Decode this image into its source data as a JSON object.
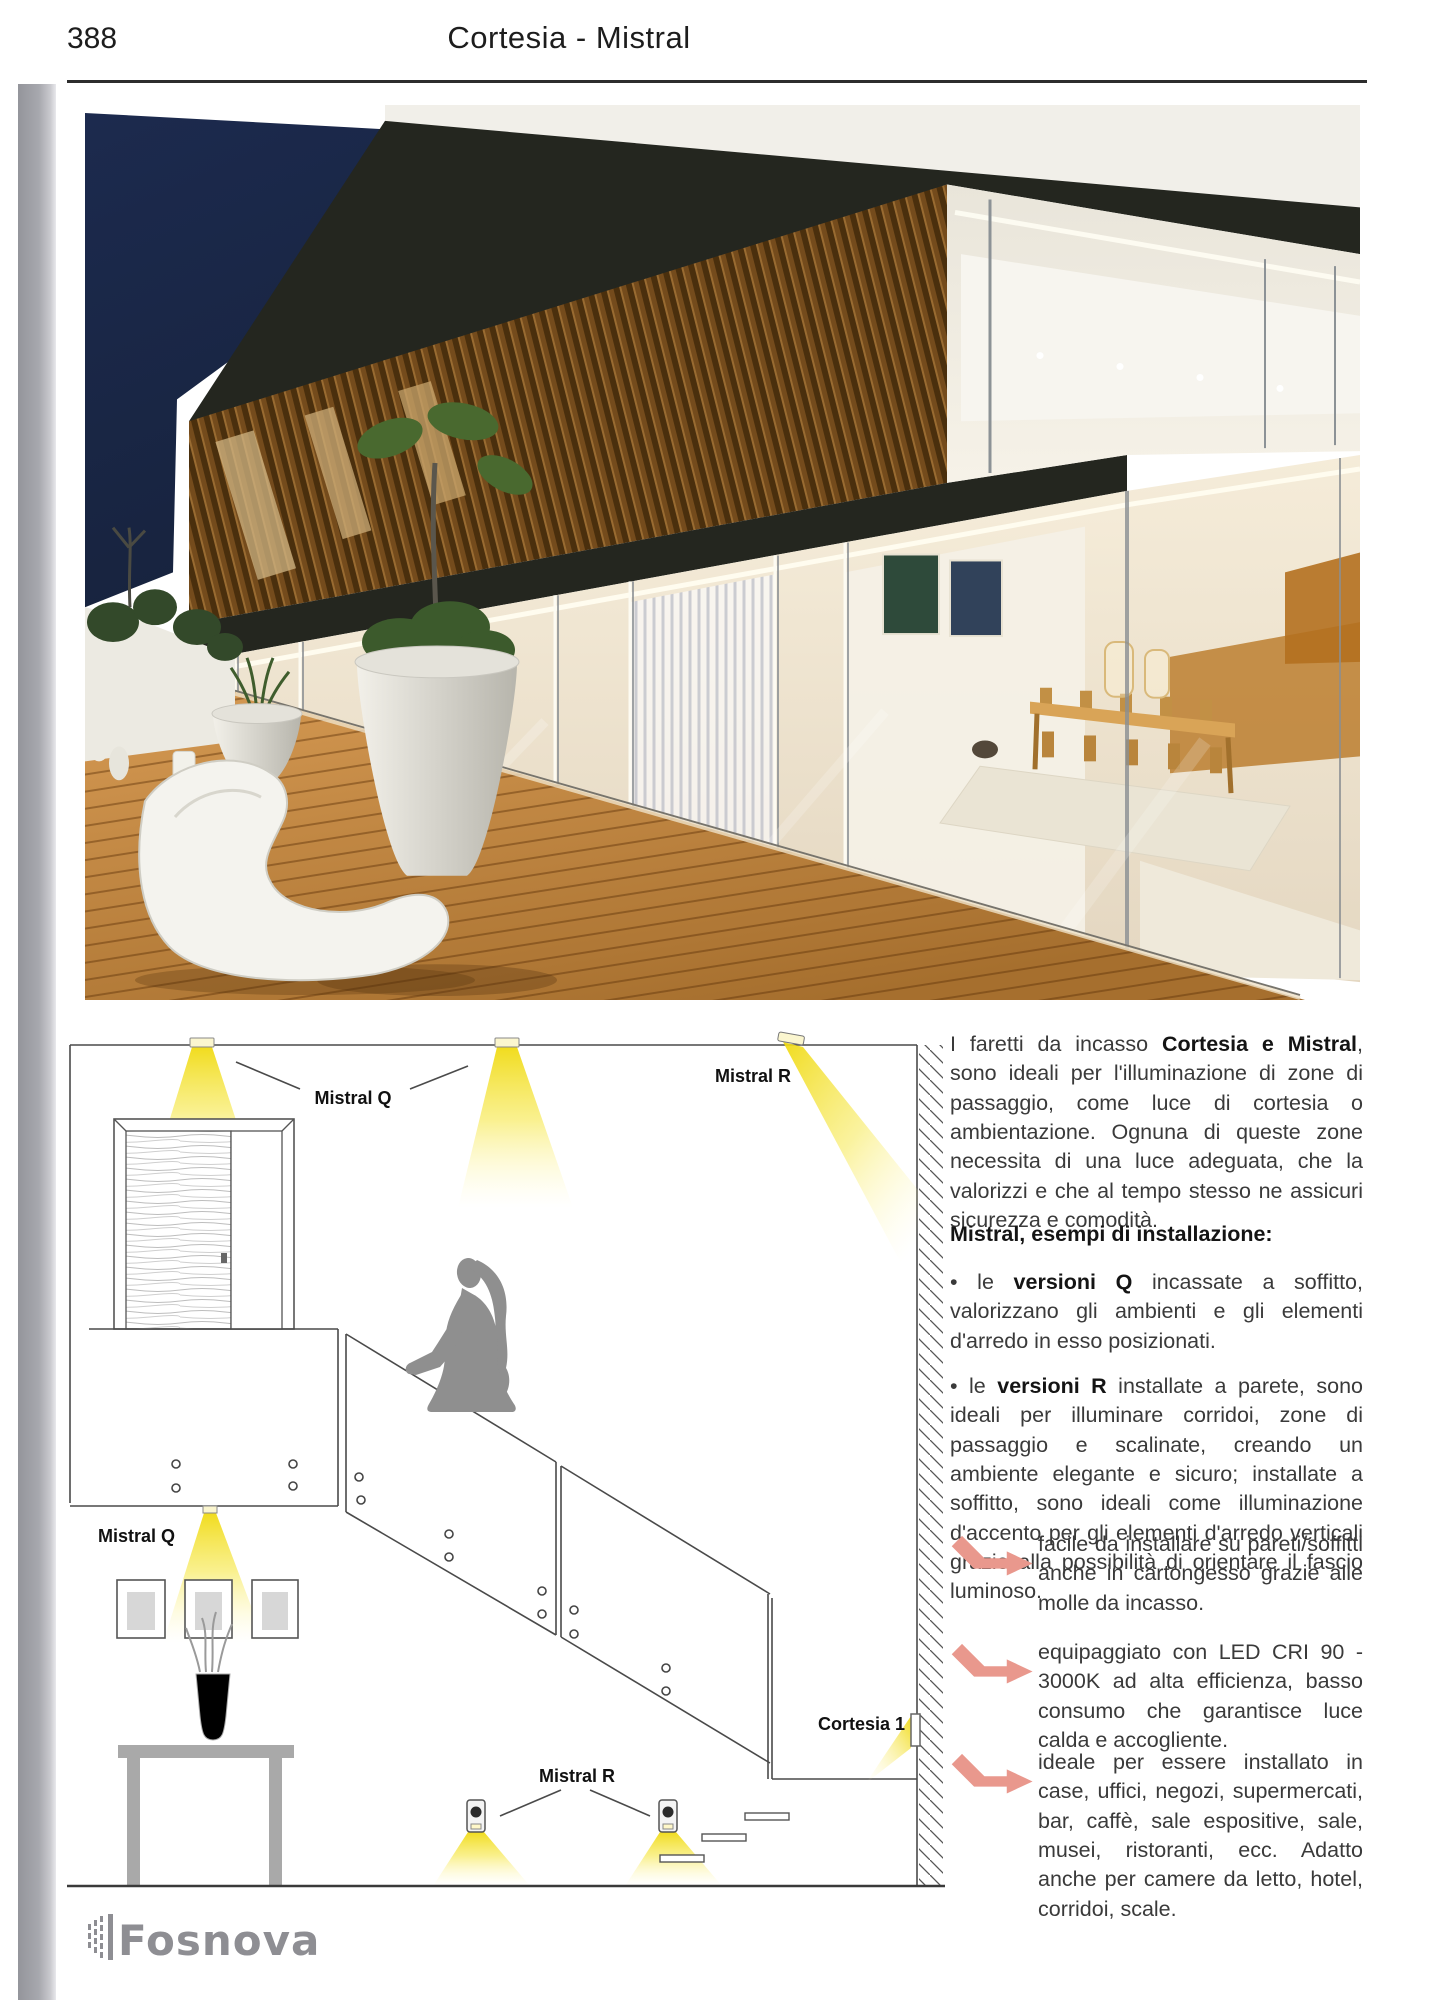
{
  "page": {
    "number": "388",
    "title": "Cortesia - Mistral"
  },
  "diagram": {
    "labels": {
      "mistral_q_top": "Mistral Q",
      "mistral_r_top": "Mistral R",
      "mistral_q_wall": "Mistral Q",
      "mistral_r_bottom": "Mistral R",
      "cortesia": "Cortesia 1"
    }
  },
  "article": {
    "intro": [
      {
        "text": "I faretti da incasso "
      },
      {
        "text": "Cortesia e Mistral",
        "bold": true
      },
      {
        "text": ", sono ideali per l'illuminazione di zone di passaggio, come luce di cortesia o ambientazione. Ognuna di queste zone necessita di una luce adeguata, che la valorizzi e che al tempo stesso ne assicuri sicurezza e comodità."
      }
    ],
    "section_heading": "Mistral, esempi di installazione:",
    "bullets": [
      [
        {
          "text": "• le "
        },
        {
          "text": "versioni Q",
          "bold": true
        },
        {
          "text": " incassate a soffitto, valorizzano gli ambienti e gli elementi d'arredo in esso posizionati."
        }
      ],
      [
        {
          "text": "• le "
        },
        {
          "text": "versioni R",
          "bold": true
        },
        {
          "text": " installate a parete, sono ideali per illuminare corridoi, zone di passaggio e scalinate, creando un ambiente elegante e sicuro; installate a soffitto, sono ideali come illuminazione d'accento per gli elementi d'arredo verticali grazie alla possibilità di orientare il fascio luminoso."
        }
      ]
    ],
    "features": [
      {
        "icon": "bent-arrow-right-icon",
        "text": "facile da installare su pareti/soffitti anche in cartongesso grazie alle molle da incasso."
      },
      {
        "icon": "bent-arrow-right-icon",
        "text": "equipaggiato con LED CRI 90 - 3000K ad alta efficienza, basso consumo che garantisce luce calda e accogliente."
      },
      {
        "icon": "bent-arrow-right-icon",
        "text": "ideale per essere installato in case, uffici, negozi, supermercati, bar, caffè, sale espositive, sale, musei, ristoranti, ecc. Adatto anche per camere da letto, hotel, corridoi, scale."
      }
    ]
  },
  "footer": {
    "logo_text": "Fosnova"
  },
  "colors": {
    "arrow_accent": "#e9988d",
    "beam_yellow": "#f2dd1e",
    "logo_gray": "#8e8e93",
    "sky_navy": "#1d2c50"
  }
}
